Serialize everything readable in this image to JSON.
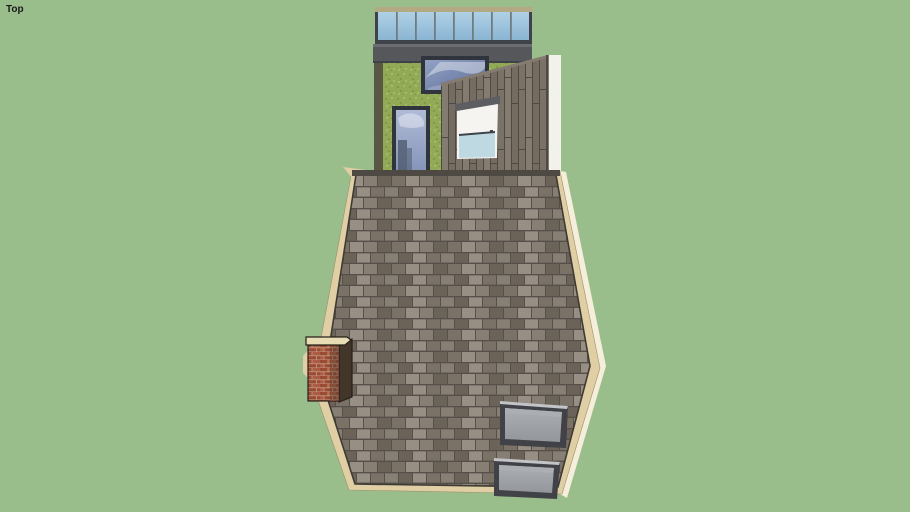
{
  "viewport": {
    "view_label": "Top"
  },
  "palette": {
    "bg": "#9ABD8C",
    "label": "#1A1A1A",
    "grass": "#92AA55",
    "grass_dark": "#81984A",
    "grass_light": "#A3BA66",
    "balustrade_cap": "#B3A982",
    "balustrade_glass_top": "#B0D1E5",
    "balustrade_glass_bottom": "#8AB5D3",
    "mullion": "#707D80",
    "frame_dark": "#3E434A",
    "parapet": "#56575B",
    "parapet_lip": "#6C6D71",
    "skylight_frame": "#30353D",
    "skylight_a_glass_top": "#93A3C6",
    "skylight_a_glass_bottom": "#5E6E98",
    "skylight_b_glass_top": "#AFBBD6",
    "skylight_b_glass_bottom": "#8795B9",
    "reflection_dark": "#4A5568",
    "cloud_white": "#EAEDF3",
    "cladding": "#746B61",
    "cladding_dark": "#4F4941",
    "cladding_light": "#847B71",
    "wall_white": "#F2F1EC",
    "lintel_gray": "#5C5E61",
    "window_white": "#F5F4F0",
    "window_glass_blue": "#BFD9E2",
    "tan_edge": "#E0CFA4",
    "tan_outer": "#F4EEDB",
    "ridge_dark": "#4E4943",
    "shingle_base": "#877E74",
    "shingle_light": "#978E84",
    "shingle_mid": "#7A7167",
    "shingle_dark": "#6B6258",
    "shingle_gap": "#555049",
    "brick": "#9C4A34",
    "brick_light": "#AB5C43",
    "brick_mortar": "#BD8F77",
    "chimney_side": "#42362A",
    "chimney_crown": "#E8DCB4",
    "chimney_outline": "#27201A",
    "rw_frame": "#404247",
    "rw_frame_light": "#C2C4C7",
    "rw_glass": "#93969B",
    "rw_glass_light": "#ABAEB2"
  }
}
